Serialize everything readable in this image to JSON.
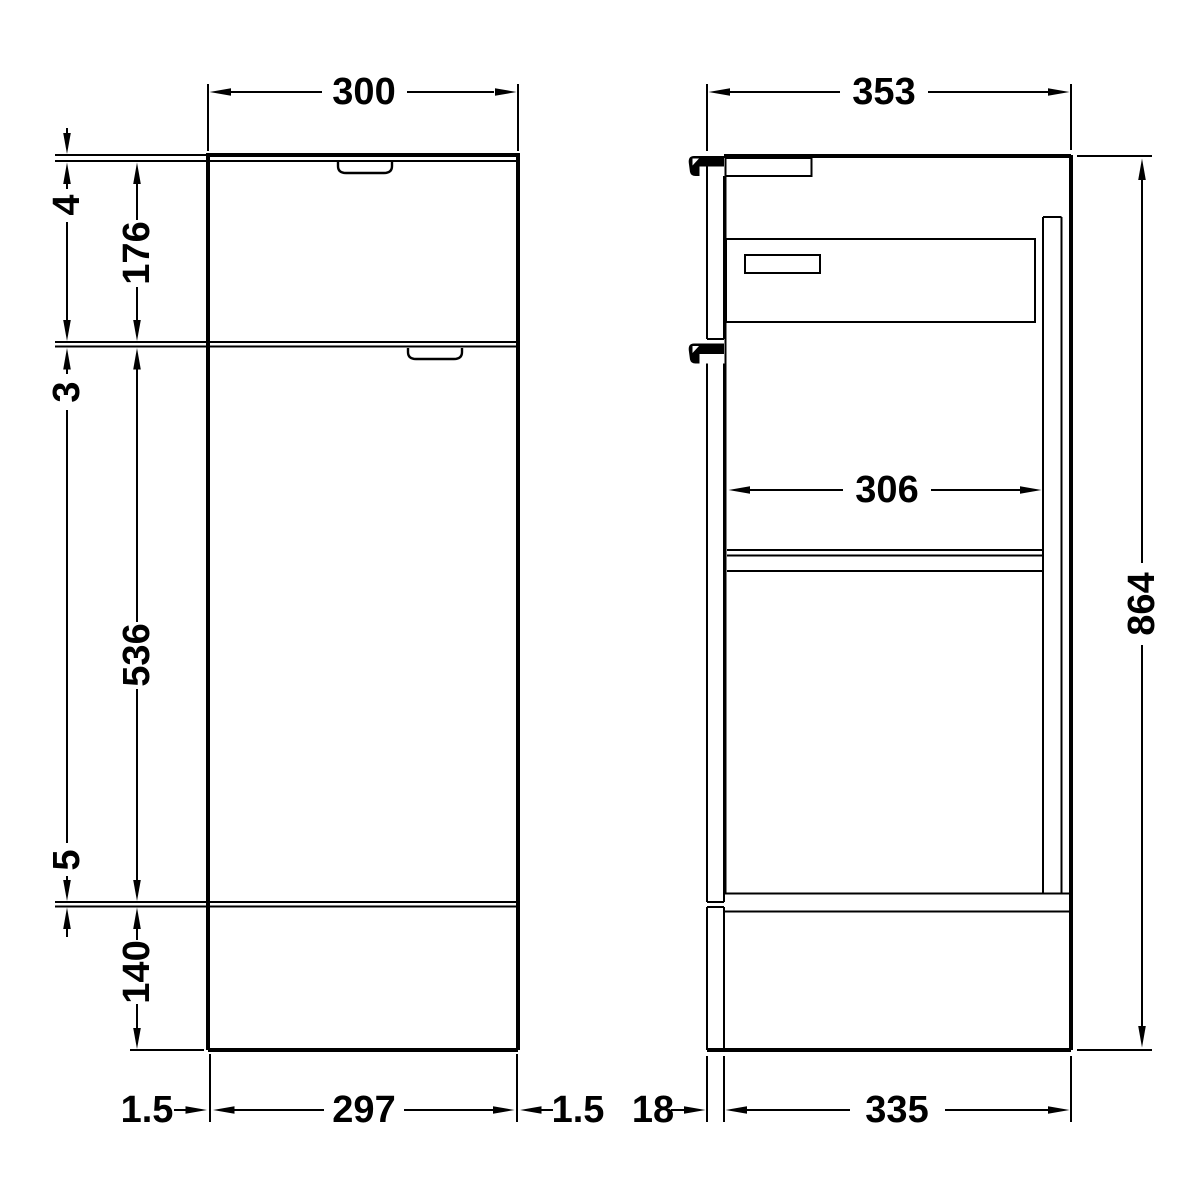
{
  "drawing": {
    "description": "Technical elevation drawing of a 300mm furniture combination unit, front view and side section view with dimensions",
    "front_view": {
      "width": "300",
      "worktop_thickness": "4",
      "drawer_front_height": "176",
      "drawer_door_gap": "3",
      "door_height": "536",
      "door_plinth_gap": "5",
      "plinth_height": "140",
      "base_left_gap": "1.5",
      "base_width": "297",
      "base_right_gap": "1.5"
    },
    "side_view": {
      "depth": "353",
      "internal_depth": "306",
      "overall_height": "864",
      "front_thickness": "18",
      "carcass_depth": "335"
    },
    "colors": {
      "line": "#000000",
      "background": "#ffffff"
    }
  }
}
